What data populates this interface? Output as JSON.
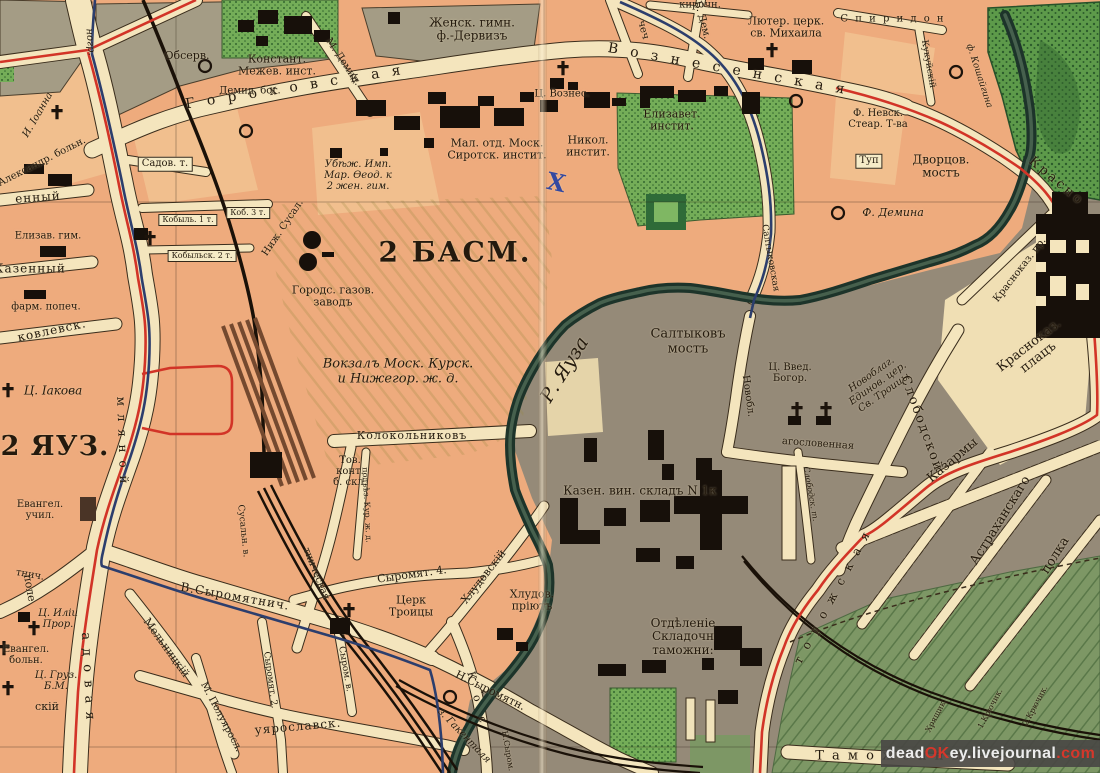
{
  "watermark": {
    "part_dead": "dead",
    "part_ok": "OK",
    "part_ey": "ey.livejournal",
    "part_com": ".com"
  },
  "colors": {
    "paper_salmon": "#eeab7d",
    "street_cream": "#f4e5bd",
    "block_olive": "#a49c85",
    "east_bank_gray": "#958a78",
    "park_green": "#74ad58",
    "field_green": "#7d9765",
    "river_dark": "#1d342a",
    "tram_red": "#d23427",
    "route_blue": "#2c3e6d",
    "rail_black": "#1a1108"
  },
  "districts": {
    "basmannaya": "2 БАСМ.",
    "yauza": "2 ЯУЗ."
  },
  "labels": [
    {
      "n": "district-label-basmannaya",
      "t": "2 БАСМ.",
      "x": 455,
      "y": 252,
      "fs": 28,
      "b": 1,
      "ls": 2
    },
    {
      "n": "district-label-yauza",
      "t": "2 ЯУЗ.",
      "x": 55,
      "y": 447,
      "fs": 27,
      "b": 1,
      "ls": 1
    },
    {
      "n": "street-gorokhovskaya",
      "t": "Г о р о х о в с к а я",
      "x": 295,
      "y": 88,
      "fs": 14,
      "rot": -9,
      "ls": 4
    },
    {
      "n": "street-voznesenskaya",
      "t": "В о з н е с е н с к а я",
      "x": 728,
      "y": 70,
      "fs": 14,
      "rot": 10,
      "ls": 4
    },
    {
      "n": "poi-observatory",
      "t": "Обсерв.",
      "x": 187,
      "y": 56,
      "fs": 11
    },
    {
      "n": "poi-demid-almshouse",
      "t": "Демид. бог.",
      "x": 250,
      "y": 91,
      "fs": 10
    },
    {
      "n": "poi-mezhevoy-institute",
      "t": "Констант.\nМежев. инст.",
      "x": 277,
      "y": 66,
      "fs": 11
    },
    {
      "n": "poi-dervis-gymnasium",
      "t": "Женск. гимн.\nф.-Дервизъ",
      "x": 472,
      "y": 30,
      "fs": 12
    },
    {
      "n": "street-m-demidovsky",
      "t": "М. Демид.",
      "x": 343,
      "y": 62,
      "fs": 10,
      "rot": 56
    },
    {
      "n": "poi-refuge-mariinsky",
      "t": "Убѣж. Имп.\nМар. Ѳеод. к\n2 жен. гим.",
      "x": 358,
      "y": 176,
      "fs": 10,
      "it": 1
    },
    {
      "n": "poi-orphan-institute",
      "t": "Мал. отд. Моск.\nСиротск. инстит.",
      "x": 497,
      "y": 150,
      "fs": 11
    },
    {
      "n": "poi-nikol-institute",
      "t": "Никол.\nинстит.",
      "x": 588,
      "y": 147,
      "fs": 11
    },
    {
      "n": "poi-voznesenia-church",
      "t": "Ц. Вознес.",
      "x": 562,
      "y": 94,
      "fs": 10
    },
    {
      "n": "poi-lutheran-church",
      "t": "Лютер. церк.\nсв. Михаила",
      "x": 786,
      "y": 28,
      "fs": 11
    },
    {
      "n": "street-kirochny",
      "t": "кирочн.",
      "x": 700,
      "y": 5,
      "fs": 10
    },
    {
      "n": "street-spiridon",
      "t": "С п и р и д о н",
      "x": 893,
      "y": 19,
      "fs": 10,
      "ls": 2
    },
    {
      "n": "street-kukuysky",
      "t": "Кукуйскій",
      "x": 928,
      "y": 64,
      "fs": 9,
      "rot": 80
    },
    {
      "n": "poi-factory-koshaygina",
      "t": "ф. Кошайгина",
      "x": 979,
      "y": 76,
      "fs": 9,
      "it": 1,
      "rot": 72
    },
    {
      "n": "poi-elizavet-institute",
      "t": "Елизавет.\nинстит.",
      "x": 672,
      "y": 121,
      "fs": 11
    },
    {
      "n": "poi-nevsky-stearin",
      "t": "Ф. Невск.\nСтеар. Т-ва",
      "x": 878,
      "y": 119,
      "fs": 10
    },
    {
      "n": "street-tupik",
      "t": "Туп",
      "x": 869,
      "y": 161,
      "fs": 10,
      "box": 1
    },
    {
      "n": "poi-dvortsov-bridge",
      "t": "Дворцов.\nмостъ",
      "x": 941,
      "y": 167,
      "fs": 12
    },
    {
      "n": "poi-factory-demina",
      "t": "Ф. Демина",
      "x": 893,
      "y": 213,
      "fs": 11,
      "it": 1
    },
    {
      "n": "street-krasnokazarmennaya",
      "t": "Красно",
      "x": 1056,
      "y": 182,
      "fs": 13,
      "rot": 40,
      "ls": 3
    },
    {
      "n": "street-krasnokaz-proezd",
      "t": "Красноказ. пр.",
      "x": 1020,
      "y": 270,
      "fs": 10,
      "rot": -52
    },
    {
      "n": "poi-krasnokaz-plats",
      "t": "Красноказ.\nплацъ",
      "x": 1034,
      "y": 352,
      "fs": 13,
      "rot": -38
    },
    {
      "n": "street-saltykovskaya",
      "t": "Салтыковская",
      "x": 770,
      "y": 258,
      "fs": 9,
      "rot": 80
    },
    {
      "n": "poi-saltykov-bridge",
      "t": "Салтыковъ\nмостъ",
      "x": 688,
      "y": 342,
      "fs": 13
    },
    {
      "n": "river-yauza-label",
      "t": "Р. Яуза",
      "x": 565,
      "y": 370,
      "fs": 19,
      "it": 1,
      "rot": -58
    },
    {
      "n": "street-novoblagoslovennaya-v",
      "t": "Новобл.",
      "x": 748,
      "y": 396,
      "fs": 10,
      "rot": 82
    },
    {
      "n": "street-novoblagoslovennaya-h",
      "t": "агословенная",
      "x": 818,
      "y": 444,
      "fs": 10,
      "rot": 4
    },
    {
      "n": "poi-vvedenia-church",
      "t": "Ц. Введ.\nБогор.",
      "x": 790,
      "y": 373,
      "fs": 10
    },
    {
      "n": "poi-edinoverie-church",
      "t": "Новоблаг.\nЕдинов. цер.\nСв. Троицы",
      "x": 878,
      "y": 384,
      "fs": 10,
      "it": 1,
      "rot": -35
    },
    {
      "n": "street-slobodskoy",
      "t": "Слободской",
      "x": 921,
      "y": 424,
      "fs": 13,
      "rot": 70,
      "ls": 2
    },
    {
      "n": "street-slobodskoy-tupik",
      "t": "Слободск. т.",
      "x": 810,
      "y": 494,
      "fs": 8,
      "it": 1,
      "rot": 80
    },
    {
      "n": "poi-wine-warehouse",
      "t": "Казен. вин. складъ N 1к",
      "x": 640,
      "y": 491,
      "fs": 12
    },
    {
      "n": "poi-customs-depot",
      "t": "Отдѣленіе\nСкладочн\nтаможни:",
      "x": 683,
      "y": 637,
      "fs": 12
    },
    {
      "n": "poi-barracks-1",
      "t": "Казармы",
      "x": 953,
      "y": 461,
      "fs": 13,
      "rot": -40
    },
    {
      "n": "poi-barracks-2",
      "t": "Астраханскаго",
      "x": 1001,
      "y": 521,
      "fs": 13,
      "rot": -58
    },
    {
      "n": "poi-barracks-3",
      "t": "полка",
      "x": 1056,
      "y": 556,
      "fs": 13,
      "rot": -58
    },
    {
      "n": "street-zolotorozhskaya",
      "t": "т о р о ж с к а я",
      "x": 833,
      "y": 597,
      "fs": 12,
      "rot": -62,
      "ls": 3
    },
    {
      "n": "street-tamozhenny",
      "t": "Т а м о ж е н н ы й",
      "x": 898,
      "y": 757,
      "fs": 13,
      "ls": 2
    },
    {
      "n": "lane-khryashchik",
      "t": "Хрящик.",
      "x": 937,
      "y": 716,
      "fs": 8,
      "rot": -62
    },
    {
      "n": "lane-kryuchik-1",
      "t": "1.Крючик.",
      "x": 991,
      "y": 709,
      "fs": 8,
      "rot": -62
    },
    {
      "n": "lane-kryuchik-2",
      "t": "2.Крючик.",
      "x": 1036,
      "y": 706,
      "fs": 8,
      "rot": -62
    },
    {
      "n": "poi-khludov-shelter",
      "t": "Хлудов.\nпріютъ",
      "x": 532,
      "y": 601,
      "fs": 11
    },
    {
      "n": "street-khludovsky",
      "t": "Хлудовскій",
      "x": 484,
      "y": 577,
      "fs": 11,
      "rot": -52
    },
    {
      "n": "street-n-syromyatnicheskaya",
      "t": "Н.Сыромятн.",
      "x": 490,
      "y": 691,
      "fs": 11,
      "rot": 26
    },
    {
      "n": "street-n-syrom-part",
      "t": "Н.Сыром.",
      "x": 507,
      "y": 751,
      "fs": 8,
      "rot": 80
    },
    {
      "n": "poi-gakental-factory",
      "t": "з. Гакенталя",
      "x": 464,
      "y": 736,
      "fs": 10,
      "it": 1,
      "rot": 46
    },
    {
      "n": "street-kostomarovsky",
      "t": "К о с",
      "x": 477,
      "y": 700,
      "fs": 11,
      "rot": 76,
      "ls": 6
    },
    {
      "n": "street-syromyatnichesky-4",
      "t": "Сыромят. 4.",
      "x": 412,
      "y": 575,
      "fs": 11,
      "rot": -8
    },
    {
      "n": "poi-troitsy-church",
      "t": "Церк\nТроицы",
      "x": 411,
      "y": 607,
      "fs": 11
    },
    {
      "n": "street-syromyatnicheskaya",
      "t": "тническая",
      "x": 316,
      "y": 574,
      "fs": 10,
      "rot": 68
    },
    {
      "n": "street-syromyatnichesky-2",
      "t": "Сыромят. 2.",
      "x": 270,
      "y": 680,
      "fs": 9,
      "rot": 82
    },
    {
      "n": "street-syromyatnicheskaya-nab",
      "t": "Сыром. в.",
      "x": 345,
      "y": 669,
      "fs": 9,
      "rot": 80
    },
    {
      "n": "street-poluyaroslavskaya",
      "t": "уярославск.",
      "x": 298,
      "y": 727,
      "fs": 12,
      "rot": -5,
      "ls": 1
    },
    {
      "n": "street-m-poluyaroslavsky",
      "t": "М. Полуяросл.",
      "x": 221,
      "y": 717,
      "fs": 10,
      "rot": 62
    },
    {
      "n": "street-melnitsky",
      "t": "Мельницкій",
      "x": 166,
      "y": 648,
      "fs": 11,
      "rot": 54
    },
    {
      "n": "street-v-syromyatnicheskaya",
      "t": "В.Сыромятнич.",
      "x": 235,
      "y": 597,
      "fs": 12,
      "rot": 10,
      "ls": 1
    },
    {
      "n": "street-tnich-part",
      "t": "тнич.",
      "x": 30,
      "y": 575,
      "fs": 10,
      "rot": 10
    },
    {
      "n": "street-susalny",
      "t": "Сусальн. в.",
      "x": 243,
      "y": 531,
      "fs": 9,
      "rot": 84
    },
    {
      "n": "street-kolokolnikov",
      "t": "Колокольниковъ",
      "x": 412,
      "y": 436,
      "fs": 11,
      "ls": 1
    },
    {
      "n": "poi-goods-office",
      "t": "Тов.\nконт.\nб. скл.",
      "x": 350,
      "y": 472,
      "fs": 10
    },
    {
      "n": "street-podezd-kur",
      "t": "подъѣз. Кур. ж. д.",
      "x": 366,
      "y": 505,
      "fs": 8,
      "rot": 87
    },
    {
      "n": "poi-kursk-station",
      "t": "Вокзалъ Моск. Курск.\nи Нижегор. ж. д.",
      "x": 398,
      "y": 372,
      "fs": 13,
      "it": 1
    },
    {
      "n": "poi-gas-works",
      "t": "Городс. газов.\nзаводъ",
      "x": 333,
      "y": 297,
      "fs": 11
    },
    {
      "n": "street-nizh-susalny",
      "t": "Ниж. Сусал.",
      "x": 283,
      "y": 228,
      "fs": 10,
      "rot": -56
    },
    {
      "n": "lane-kobylsky-1",
      "t": "Кобыль. 1 т.",
      "x": 188,
      "y": 220,
      "fs": 8,
      "box": 1
    },
    {
      "n": "lane-kobylsky-3",
      "t": "Коб. 3 т.",
      "x": 248,
      "y": 213,
      "fs": 8,
      "box": 1
    },
    {
      "n": "lane-kobylsky-2",
      "t": "Кобыльск. 2 т.",
      "x": 202,
      "y": 256,
      "fs": 8,
      "box": 1
    },
    {
      "n": "poi-iakova-church",
      "t": "Ц. Іакова",
      "x": 53,
      "y": 391,
      "fs": 12,
      "it": 1
    },
    {
      "n": "street-yakovlevskaya",
      "t": "ковлевск.",
      "x": 52,
      "y": 331,
      "fs": 12,
      "rot": -12,
      "ls": 1
    },
    {
      "n": "street-kazenny",
      "t": "Казенный",
      "x": 30,
      "y": 269,
      "fs": 12,
      "ls": 1
    },
    {
      "n": "poi-farm-popech",
      "t": "фарм. попеч.",
      "x": 46,
      "y": 307,
      "fs": 10
    },
    {
      "n": "poi-elizav-gymnasium",
      "t": "Елизав. гим.",
      "x": 48,
      "y": 236,
      "fs": 10
    },
    {
      "n": "street-enny-part",
      "t": "енный",
      "x": 38,
      "y": 198,
      "fs": 12,
      "ls": 1,
      "rot": -4
    },
    {
      "n": "poi-ioanna-church",
      "t": "И. Іоанна",
      "x": 38,
      "y": 115,
      "fs": 10,
      "it": 1,
      "rot": -60
    },
    {
      "n": "poi-alexandr-hospital",
      "t": "Александр. больн.",
      "x": 42,
      "y": 162,
      "fs": 10,
      "rot": -27
    },
    {
      "n": "poi-evangel-school",
      "t": "Евангел.\nучил.",
      "x": 40,
      "y": 510,
      "fs": 10
    },
    {
      "n": "street-pole",
      "t": "поле",
      "x": 29,
      "y": 588,
      "fs": 11,
      "rot": 80
    },
    {
      "n": "poi-ilii-church",
      "t": "Ц. Иліи\nПрор.",
      "x": 58,
      "y": 619,
      "fs": 10,
      "it": 1
    },
    {
      "n": "poi-evangel-hospital",
      "t": "Евангел.\nбольн.",
      "x": 26,
      "y": 655,
      "fs": 10
    },
    {
      "n": "poi-gruz-church",
      "t": "Ц. Груз.\nБ.М.",
      "x": 56,
      "y": 681,
      "fs": 10,
      "it": 1
    },
    {
      "n": "street-sky-part",
      "t": "скій",
      "x": 47,
      "y": 707,
      "fs": 11
    },
    {
      "n": "street-sadovaya",
      "t": "а д о в а я",
      "x": 87,
      "y": 677,
      "fs": 13,
      "rot": 87,
      "ls": 2
    },
    {
      "n": "street-zemlyanoy-val",
      "t": "м л я н о й",
      "x": 122,
      "y": 441,
      "fs": 12,
      "rot": 88,
      "ls": 2
    },
    {
      "n": "street-nogr-part",
      "t": "ногр.",
      "x": 90,
      "y": 42,
      "fs": 10,
      "rot": 85,
      "it": 1
    },
    {
      "n": "street-chech-part",
      "t": "чеч",
      "x": 643,
      "y": 30,
      "fs": 10,
      "rot": 75
    },
    {
      "n": "street-b-demidovsky",
      "t": "Б. Дем.",
      "x": 702,
      "y": 20,
      "fs": 10,
      "rot": 75
    },
    {
      "n": "lane-sadovy-tupik",
      "t": "Садов. т.",
      "x": 165,
      "y": 164,
      "fs": 10,
      "box": 1
    },
    {
      "n": "x-mark",
      "t": "X",
      "x": 556,
      "y": 183,
      "fs": 24,
      "b": 1,
      "rot": 12,
      "c": "#3448a0"
    }
  ]
}
